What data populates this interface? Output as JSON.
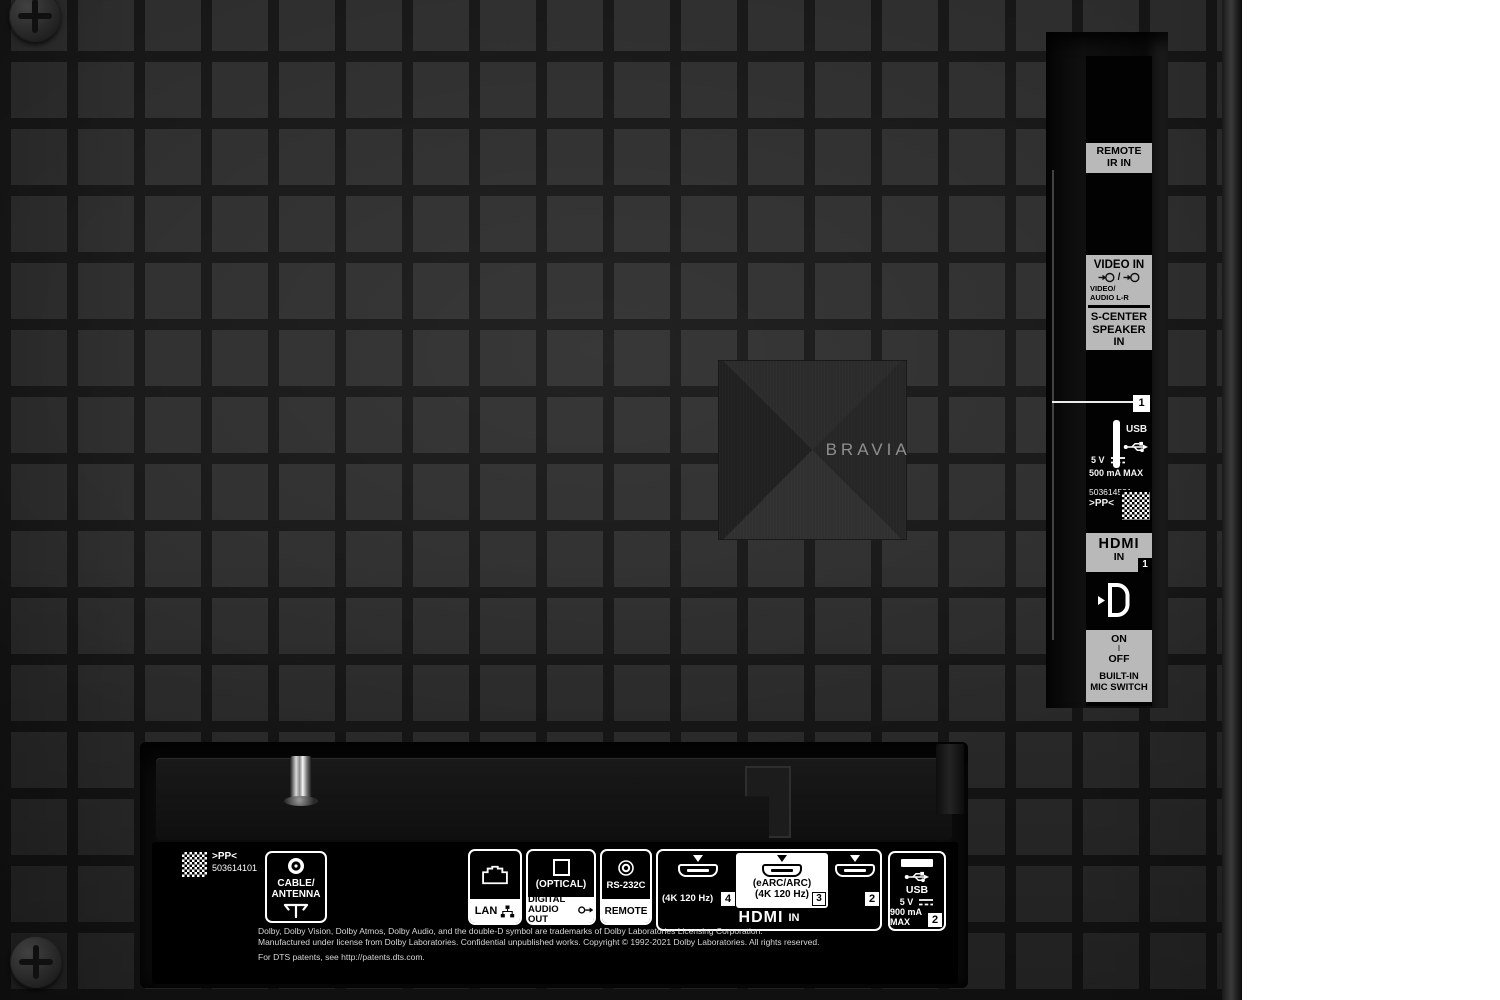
{
  "colors": {
    "background": "#ffffff",
    "tile": "#2d2d2d",
    "gap": "#161616",
    "label_gray": "#b9b9b9",
    "label_white": "#ffffff",
    "panel_black": "#000000"
  },
  "brand_plate": {
    "label": "BRAVIA"
  },
  "side_panel": {
    "remote_ir_label": "REMOTE\nIR IN",
    "video_in_title": "VIDEO IN",
    "video_in_separator": "/",
    "video_audio_sub": "VIDEO/\nAUDIO L-R",
    "s_center_label": "S-CENTER\nSPEAKER IN",
    "usb_badge": "1",
    "usb_label": "USB",
    "usb_voltage": "5 V",
    "usb_current": "500 mA MAX",
    "serial_number": "503614531",
    "pp_mark": ">PP<",
    "hdmi_logo": "HDMI",
    "hdmi_in": "IN",
    "hdmi_badge": "1",
    "mic_on": "ON",
    "mic_divider": "I",
    "mic_off": "OFF",
    "mic_label": "BUILT-IN\nMIC SWITCH"
  },
  "bottom_panel": {
    "pp_mark": ">PP<",
    "serial_number": "503614101",
    "cable_antenna_label": "CABLE/\nANTENNA",
    "lan_label": "LAN",
    "optical_label": "(OPTICAL)",
    "digital_audio_out_label": "DIGITAL\nAUDIO OUT",
    "rs232c_label": "RS-232C",
    "remote_label": "REMOTE",
    "hdmi4_spec": "(4K 120 Hz)",
    "hdmi4_badge": "4",
    "hdmi3_spec1": "(eARC/ARC)",
    "hdmi3_spec2": "(4K 120 Hz)",
    "hdmi3_badge": "3",
    "hdmi2_badge": "2",
    "hdmi_logo": "HDMI",
    "hdmi_in": "IN",
    "usb_label": "USB",
    "usb_voltage": "5 V",
    "usb_current": "900 mA MAX",
    "usb_badge": "2",
    "legal_line1": "Dolby, Dolby Vision, Dolby Atmos, Dolby Audio, and the double-D symbol are trademarks of Dolby Laboratories Licensing Corporation.",
    "legal_line2": "Manufactured under license from Dolby Laboratories. Confidential unpublished works. Copyright © 1992-2021 Dolby Laboratories. All rights reserved.",
    "legal_line3": "For DTS patents, see http://patents.dts.com."
  }
}
